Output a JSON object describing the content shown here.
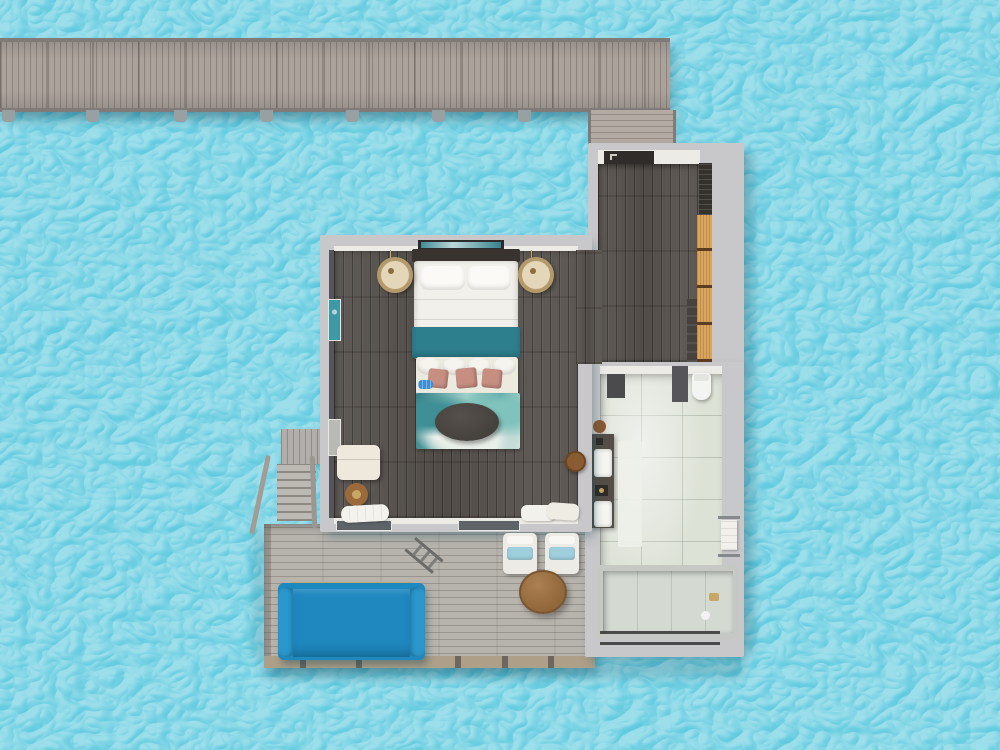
{
  "scene": {
    "type": "top-down 3D render",
    "subject": "overwater-villa-floorplan",
    "environment": "tropical-sea-water"
  },
  "colors": {
    "water": "#5cc9de",
    "water_sparkle": "#ffffff",
    "pier_wood": "#aaa29b",
    "pier_edge": "#807b78",
    "walkway_wood": "#b2aaa3",
    "deck_wood": "#b7b3ad",
    "deck_fascia": "#ad9f88",
    "wall": "#c8c7c9",
    "wall_inner": "#edebe6",
    "floor_wood": "#57524d",
    "tile": "#dde2d7",
    "accent_teal": "#2e7f8e",
    "daybed_blue": "#1e88bf",
    "cushion_blue": "#9fcfdd",
    "pillow_pink": "#c78f82",
    "wardrobe_tan": "#d8a55e",
    "wood_brown": "#9a7044",
    "dark_fixture": "#3a3834",
    "linen": "#f2f0ea",
    "gold": "#c7a766",
    "glass": "#5d6367",
    "shadow": "#0c5468"
  },
  "structure": {
    "pier": {
      "orientation": "horizontal-top",
      "pilings": 7
    },
    "walkway": {
      "connects": "pier-to-entry"
    },
    "entry_hall": {
      "doormat": 1,
      "louver_panel": 1,
      "closet_shelves": 4,
      "stone_strip": 1
    },
    "bedroom": {
      "wall_art": 1,
      "headboard": 1,
      "bed": 1,
      "bed_pillows": 2,
      "teal_runner": 1,
      "bench_bolsters": 4,
      "accent_pillows_pink": 3,
      "blue_roll": 1,
      "area_rug": 1,
      "coffee_table": 1,
      "pendant_lamps": 2,
      "window_frames": 2,
      "armchair": 1,
      "side_table": 1,
      "drum_stool": 1,
      "towel_piles": 2,
      "glass_doors": 2
    },
    "bathroom": {
      "toilet": 1,
      "shower_partitions": 2,
      "vanity_sinks": 2,
      "bath_mat": 1,
      "towel_rack": 1,
      "bathtub": 1,
      "floor_slats": 1,
      "wood_tray": 1
    },
    "deck": {
      "sun_daybed": 1,
      "lounge_chairs": 2,
      "round_table": 1,
      "sea_ladder": 1,
      "stairs": 1,
      "railing_posts": 5
    }
  }
}
